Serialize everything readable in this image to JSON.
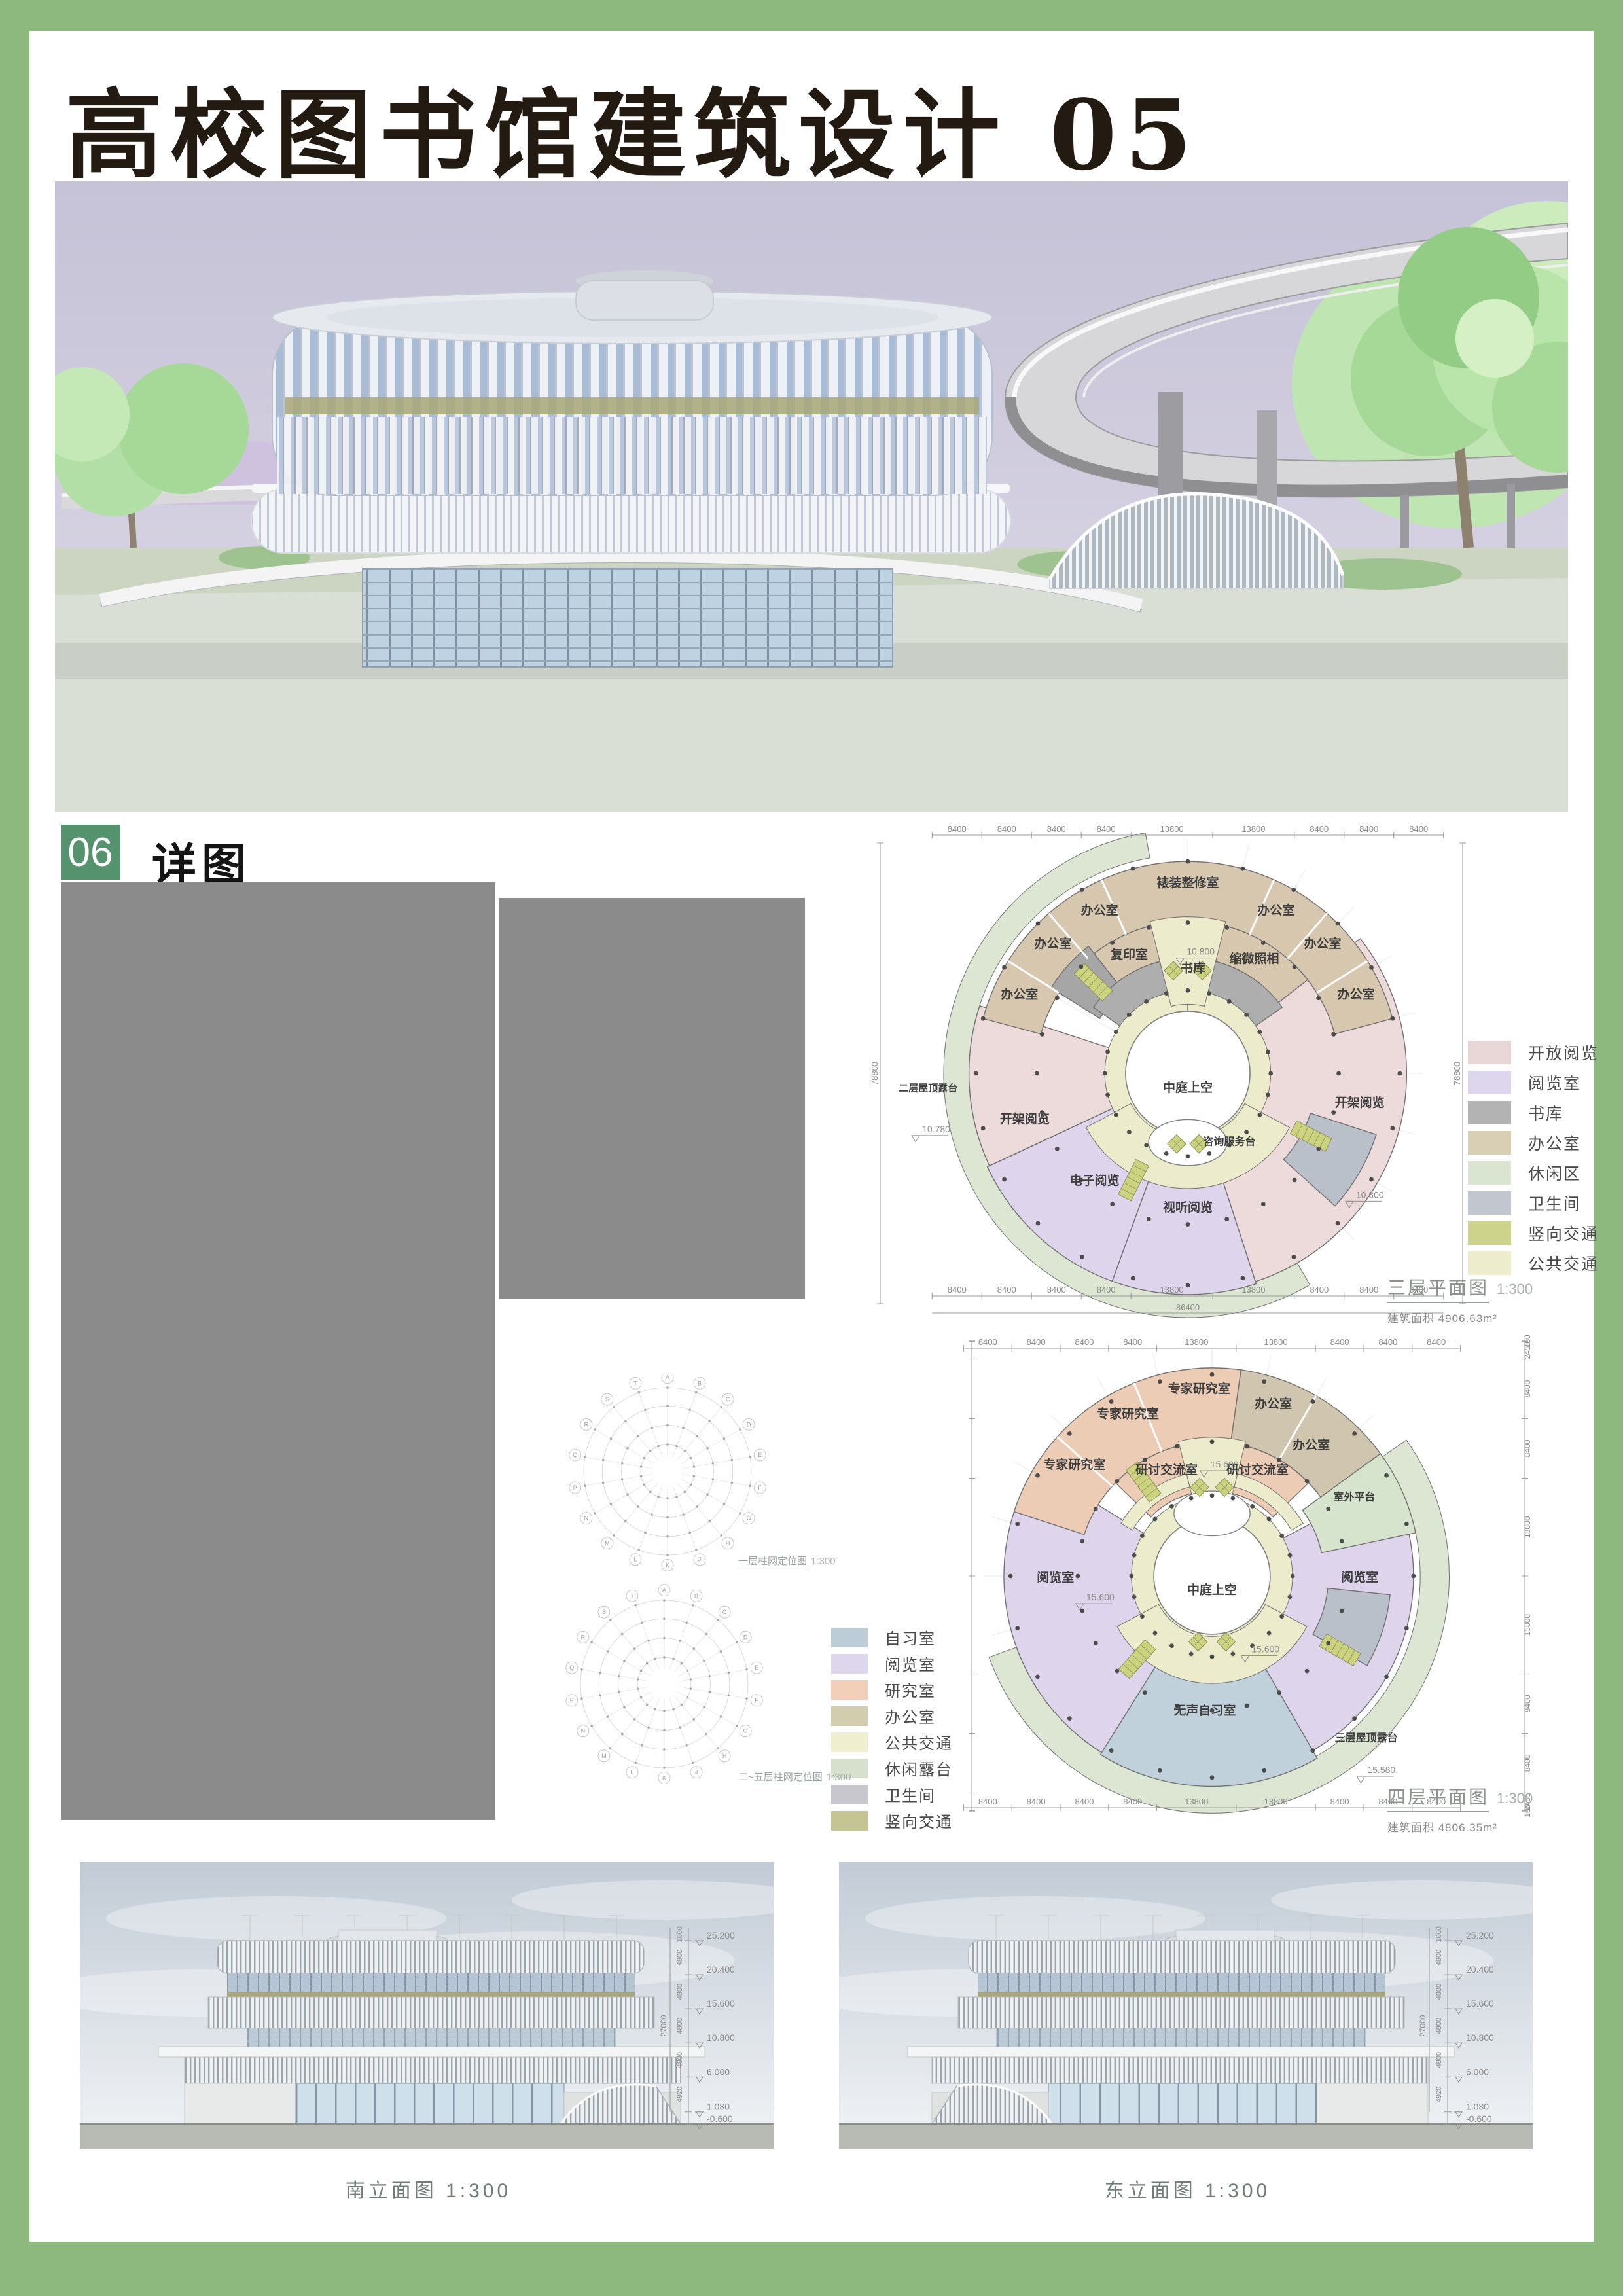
{
  "page": {
    "title": "高校图书馆建筑设计 05",
    "section_number": "06",
    "section_label": "详图"
  },
  "colors": {
    "frame_green": "#8db97e",
    "badge_green": "#55926e",
    "placeholder_gray": "#8b8b8b",
    "sky_lavender": "#c7c3d8",
    "olive_band": "#a8a87b",
    "terrace_green": "#dce6d3"
  },
  "plans": [
    {
      "title": "三层平面图",
      "scale": "1:300",
      "area": "建筑面积 4906.63m²",
      "atrium": 0.27,
      "bump": {
        "a": 180,
        "r": 0.3
      },
      "sectors": [
        {
          "a0": 150,
          "a1": 350,
          "r0": 0.95,
          "r1": 1.06,
          "c": "#dce6d3",
          "sw": 1
        },
        {
          "a0": 245,
          "a1": 288,
          "r0": 0.34,
          "r1": 0.95,
          "c": "#eddbdb"
        },
        {
          "a0": 52,
          "a1": 162,
          "r0": 0.34,
          "r1": 0.95,
          "c": "#eddbdb"
        },
        {
          "a0": 162,
          "a1": 200,
          "r0": 0.36,
          "r1": 0.96,
          "c": "#ded5ec"
        },
        {
          "a0": 200,
          "a1": 245,
          "r0": 0.36,
          "r1": 0.96,
          "c": "#ded5ec"
        },
        {
          "a0": -75,
          "a1": 75,
          "r0": 0.66,
          "r1": 0.92,
          "c": "#d7c7ae"
        },
        {
          "a0": -58,
          "a1": -38,
          "r0": 0.45,
          "r1": 0.7,
          "c": "#a6a6a6"
        },
        {
          "a0": -38,
          "a1": -13,
          "r0": 0.45,
          "r1": 0.66,
          "c": "#d7c7ae"
        },
        {
          "a0": 13,
          "a1": 52,
          "r0": 0.45,
          "r1": 0.66,
          "c": "#d7c7ae"
        },
        {
          "a0": -55,
          "a1": 55,
          "r0": 0.33,
          "r1": 0.5,
          "c": "#aeaeae"
        },
        {
          "a0": 108,
          "a1": 132,
          "r0": 0.56,
          "r1": 0.86,
          "c": "#bac0ca"
        },
        {
          "a0": 0,
          "a1": 359.9,
          "r0": 0.27,
          "r1": 0.36,
          "c": "#ececcc",
          "sw": 1
        },
        {
          "a0": -14,
          "a1": 14,
          "r0": 0.3,
          "r1": 0.68,
          "c": "#ececcc",
          "sw": 1
        },
        {
          "a0": 118,
          "a1": 242,
          "r0": 0.28,
          "r1": 0.5,
          "c": "#ececcc",
          "sw": 1
        }
      ],
      "dividers": [
        {
          "a": -58,
          "r0": 0.66,
          "r1": 0.92
        },
        {
          "a": -41,
          "r0": 0.66,
          "r1": 0.92
        },
        {
          "a": -24,
          "r0": 0.66,
          "r1": 0.92
        },
        {
          "a": 24,
          "r0": 0.66,
          "r1": 0.92
        },
        {
          "a": 41,
          "r0": 0.66,
          "r1": 0.92
        },
        {
          "a": 58,
          "r0": 0.66,
          "r1": 0.92
        }
      ],
      "rooms": [
        {
          "t": "办公室",
          "a": -66,
          "r": 0.8
        },
        {
          "t": "办公室",
          "a": -47,
          "r": 0.8
        },
        {
          "t": "办公室",
          "a": -29,
          "r": 0.79
        },
        {
          "t": "裱装整修室",
          "a": 0,
          "r": 0.81
        },
        {
          "t": "办公室",
          "a": 29,
          "r": 0.79
        },
        {
          "t": "办公室",
          "a": 47,
          "r": 0.8
        },
        {
          "t": "办公室",
          "a": 66,
          "r": 0.8
        },
        {
          "t": "复印室",
          "a": -27,
          "r": 0.56
        },
        {
          "t": "缩微照相",
          "a": 31,
          "r": 0.56
        },
        {
          "t": "书库",
          "a": 3,
          "r": 0.44
        },
        {
          "t": "开架阅览",
          "a": 101,
          "r": 0.76
        },
        {
          "t": "开架阅览",
          "a": 253,
          "r": 0.74
        },
        {
          "t": "电子阅览",
          "a": 220,
          "r": 0.63
        },
        {
          "t": "视听阅览",
          "a": 180,
          "r": 0.6
        },
        {
          "t": "咨询服务台",
          "a": 150,
          "r": 0.36,
          "s": 16
        },
        {
          "t": "中庭上空",
          "a": 180,
          "r": 0.08
        },
        {
          "t": "二层屋顶露台",
          "a": 266,
          "r": 1.13,
          "s": 15
        }
      ],
      "level_markers": [
        {
          "t": "10.800",
          "a": 2,
          "r": 0.51
        },
        {
          "t": "10.800",
          "a": 126,
          "r": 0.93
        },
        {
          "t": "10.780",
          "a": 257,
          "r": 1.16
        }
      ],
      "stairs": [
        {
          "a": -46,
          "r": 0.57
        },
        {
          "a": 117,
          "r": 0.6
        },
        {
          "a": 207,
          "r": 0.52
        }
      ],
      "lifts": [
        {
          "a": -8,
          "r": 0.45
        },
        {
          "a": 8,
          "r": 0.45
        },
        {
          "a": 171,
          "r": 0.31
        },
        {
          "a": 189,
          "r": 0.31
        }
      ],
      "dot_rings": [
        0.36,
        0.655,
        0.92
      ],
      "dims": {
        "h_series": [
          "8400",
          "8400",
          "8400",
          "8400",
          "13800",
          "13800",
          "8400",
          "8400",
          "8400"
        ],
        "h_total": "86400",
        "v_total": "78800"
      },
      "legend": [
        {
          "label": "开放阅览",
          "color": "#e9d6d6"
        },
        {
          "label": "阅览室",
          "color": "#ded6ec"
        },
        {
          "label": "书库",
          "color": "#b3b3b3"
        },
        {
          "label": "办公室",
          "color": "#d8cfb4"
        },
        {
          "label": "休闲区",
          "color": "#d9e5d1"
        },
        {
          "label": "卫生间",
          "color": "#c2c7cf"
        },
        {
          "label": "竖向交通",
          "color": "#cdd38b"
        },
        {
          "label": "公共交通",
          "color": "#ededcd"
        }
      ]
    },
    {
      "title": "四层平面图",
      "scale": "1:300",
      "area": "建筑面积 4806.35m²",
      "atrium": 0.26,
      "bump": {
        "a": 0,
        "r": 0.28
      },
      "sectors": [
        {
          "a0": 55,
          "a1": 250,
          "r0": 0.93,
          "r1": 1.06,
          "c": "#dce6d3",
          "sw": 1
        },
        {
          "a0": 212,
          "a1": 302,
          "r0": 0.33,
          "r1": 0.93,
          "c": "#ded5ec"
        },
        {
          "a0": 62,
          "a1": 150,
          "r0": 0.35,
          "r1": 0.9,
          "c": "#ded5ec"
        },
        {
          "a0": 150,
          "a1": 212,
          "r0": 0.36,
          "r1": 0.94,
          "c": "#c0d1dc"
        },
        {
          "a0": -72,
          "a1": 8,
          "r0": 0.6,
          "r1": 0.93,
          "c": "#edccb5"
        },
        {
          "a0": 8,
          "a1": 54,
          "r0": 0.6,
          "r1": 0.93,
          "c": "#d0c5af"
        },
        {
          "a0": -46,
          "a1": -6,
          "r0": 0.38,
          "r1": 0.6,
          "c": "#edccb5"
        },
        {
          "a0": 6,
          "a1": 46,
          "r0": 0.38,
          "r1": 0.6,
          "c": "#edccb5"
        },
        {
          "a0": 54,
          "a1": 78,
          "r0": 0.5,
          "r1": 0.93,
          "c": "#d6e3cd"
        },
        {
          "a0": 96,
          "a1": 120,
          "r0": 0.52,
          "r1": 0.8,
          "c": "#bac0ca"
        },
        {
          "a0": 0,
          "a1": 359.9,
          "r0": 0.26,
          "r1": 0.36,
          "c": "#ececcc",
          "sw": 1
        },
        {
          "a0": -60,
          "a1": 60,
          "r0": 0.41,
          "r1": 0.47,
          "c": "#ececcc",
          "sw": 1
        },
        {
          "a0": -14,
          "a1": 14,
          "r0": 0.29,
          "r1": 0.62,
          "c": "#ececcc",
          "sw": 1
        },
        {
          "a0": 118,
          "a1": 242,
          "r0": 0.27,
          "r1": 0.48,
          "c": "#ececcc",
          "sw": 1
        }
      ],
      "dividers": [
        {
          "a": -48,
          "r0": 0.6,
          "r1": 0.93
        },
        {
          "a": -22,
          "r0": 0.6,
          "r1": 0.93
        },
        {
          "a": 30,
          "r0": 0.6,
          "r1": 0.93
        }
      ],
      "rooms": [
        {
          "t": "专家研究室",
          "a": -52,
          "r": 0.78
        },
        {
          "t": "专家研究室",
          "a": -28,
          "r": 0.8
        },
        {
          "t": "专家研究室",
          "a": -4,
          "r": 0.82
        },
        {
          "t": "办公室",
          "a": 20,
          "r": 0.8
        },
        {
          "t": "办公室",
          "a": 38,
          "r": 0.72
        },
        {
          "t": "研讨交流室",
          "a": -24,
          "r": 0.5
        },
        {
          "t": "研讨交流室",
          "a": 24,
          "r": 0.5
        },
        {
          "t": "室外平台",
          "a": 62,
          "r": 0.72,
          "s": 16
        },
        {
          "t": "阅览室",
          "a": 92,
          "r": 0.66
        },
        {
          "t": "阅览室",
          "a": 268,
          "r": 0.7
        },
        {
          "t": "无声自习室",
          "a": 183,
          "r": 0.62
        },
        {
          "t": "三层屋顶露台",
          "a": 137,
          "r": 1.01,
          "s": 16
        },
        {
          "t": "中庭上空",
          "a": 180,
          "r": 0.08
        }
      ],
      "level_markers": [
        {
          "t": "15.600",
          "a": 2,
          "r": 0.48
        },
        {
          "t": "15.600",
          "a": 150,
          "r": 0.4
        },
        {
          "t": "15.600",
          "a": 258,
          "r": 0.55
        },
        {
          "t": "15.580",
          "a": 141,
          "r": 1.14
        }
      ],
      "stairs": [
        {
          "a": -36,
          "r": 0.52
        },
        {
          "a": 120,
          "r": 0.66
        },
        {
          "a": 222,
          "r": 0.5
        }
      ],
      "lifts": [
        {
          "a": -8,
          "r": 0.4
        },
        {
          "a": 8,
          "r": 0.4
        },
        {
          "a": 168,
          "r": 0.3
        },
        {
          "a": 192,
          "r": 0.3
        }
      ],
      "dot_rings": [
        0.36,
        0.6,
        0.9
      ],
      "dims": {
        "h_series": [
          "8400",
          "8400",
          "8400",
          "8400",
          "13800",
          "13800",
          "8400",
          "8400",
          "8400"
        ],
        "v_series": [
          "100",
          "2455",
          "8400",
          "8400",
          "13800",
          "13800",
          "8400",
          "8400",
          "2455",
          "100"
        ]
      },
      "legend": [
        {
          "label": "自习室",
          "color": "#bccdd8"
        },
        {
          "label": "阅览室",
          "color": "#ded6ec"
        },
        {
          "label": "研究室",
          "color": "#f2cfb8"
        },
        {
          "label": "办公室",
          "color": "#d2cdae"
        },
        {
          "label": "公共交通",
          "color": "#efefd0"
        },
        {
          "label": "休闲露台",
          "color": "#d5e1cd"
        },
        {
          "label": "卫生间",
          "color": "#c7c7cd"
        },
        {
          "label": "竖向交通",
          "color": "#c5c593"
        }
      ]
    }
  ],
  "grid_diagrams": [
    {
      "caption": "一层柱网定位图",
      "scale": "1:300"
    },
    {
      "caption": "二~五层柱网定位图",
      "scale": "1:300"
    }
  ],
  "axis_letters": [
    "A",
    "B",
    "C",
    "D",
    "E",
    "F",
    "G",
    "H",
    "J",
    "K",
    "L",
    "M",
    "N",
    "P",
    "Q",
    "R",
    "S",
    "T"
  ],
  "elevations": [
    {
      "caption": "南立面图",
      "scale": "1:300",
      "levels": [
        "25.200",
        "20.400",
        "15.600",
        "10.800",
        "6.000",
        "1.080",
        "-0.600"
      ],
      "seg_dims": [
        "1800",
        "4800",
        "4800",
        "4800",
        "4800",
        "4920"
      ],
      "total": "27000"
    },
    {
      "caption": "东立面图",
      "scale": "1:300",
      "levels": [
        "25.200",
        "20.400",
        "15.600",
        "10.800",
        "6.000",
        "1.080",
        "-0.600"
      ],
      "seg_dims": [
        "1800",
        "4800",
        "4800",
        "4800",
        "4800",
        "4920"
      ],
      "total": "27000"
    }
  ]
}
